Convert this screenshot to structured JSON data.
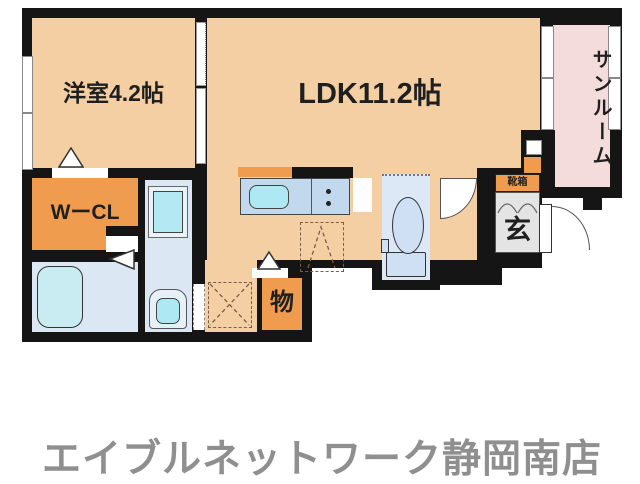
{
  "plan": {
    "western_room_label": "洋室4.2帖",
    "ldk_label": "LDK11.2帖",
    "sunroom_label": "サンルーム",
    "wcl_label": "WーCL",
    "shoebox_label": "靴箱",
    "entrance_label": "玄",
    "storage_label": "物",
    "colors": {
      "floor_peach": "#f4cfa3",
      "accent_orange": "#f09c4e",
      "sunroom_pink": "#f3dcdb",
      "wet_area_blue": "#dbe7f3",
      "fixture_cyan": "#aee8f2",
      "counter_blue": "#c2d8ec",
      "genkan_gray": "#e4e4e4",
      "wall_black": "#151515",
      "footer_gray": "#8f8f8f"
    }
  },
  "footer": {
    "store_name": "エイブルネットワーク静岡南店"
  }
}
